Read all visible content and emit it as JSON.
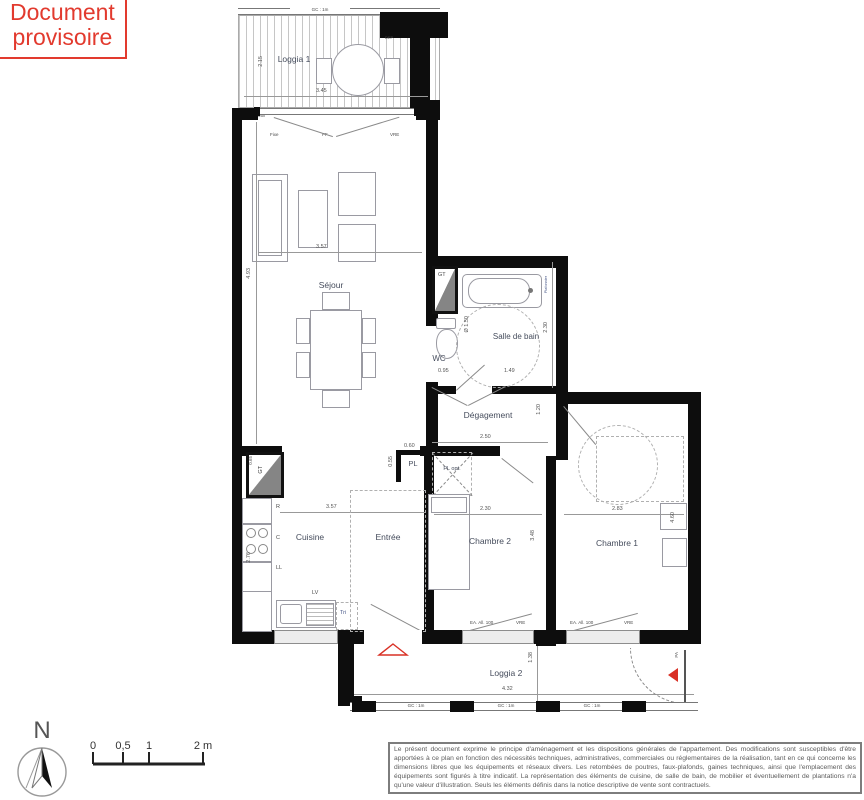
{
  "stamp": {
    "line1": "Document",
    "line2": "provisoire"
  },
  "colors": {
    "stamp_red": "#e23a2e",
    "plan_accent_red": "#d93025",
    "wall_black": "#0d0d0d"
  },
  "plan": {
    "rooms": {
      "loggia1": "Loggia 1",
      "sejour": "Séjour",
      "salle_de_bain": "Salle de bain",
      "wc": "WC",
      "degagement": "Dégagement",
      "pl": "PL",
      "pl_opt": "PL opt.",
      "cuisine": "Cuisine",
      "entree": "Entrée",
      "chambre2": "Chambre 2",
      "chambre1": "Chambre 1",
      "loggia2": "Loggia 2"
    },
    "annotations": {
      "gc": "GC : 1m",
      "fixe": "Fixe",
      "pf": "PF",
      "vre": "VRE",
      "ea": "EA. All. 100",
      "gt": "GT",
      "pa": "PA",
      "dep": "DEP",
      "seuil": "Seuil",
      "tri": "Tri",
      "lv": "LV",
      "ll": "LL",
      "c": "C",
      "r": "R",
      "plafonnier": "Plafonnier",
      "diametre": "Ø 1.50"
    },
    "dims": {
      "loggia1_h": "2.15",
      "loggia1_w": "3.45",
      "sejour_w": "3.57",
      "sejour_h": "4.93",
      "sdb_h": "2.30",
      "wc_w": "0.95",
      "sdb_w": "1.49",
      "deg_w": "2.50",
      "deg_h": "1.20",
      "pl_w": "0.60",
      "pl_h": "0.55",
      "gt_h": "0.65",
      "cuisine_w": "3.57",
      "cuisine_h": "2.76",
      "ch2_w": "2.30",
      "ch2_h": "3.48",
      "ch1_w": "2.83",
      "ch1_h": "4.60",
      "loggia2_w": "4.32",
      "loggia2_h": "1.38"
    }
  },
  "compass": {
    "label": "N"
  },
  "scale_bar": {
    "t0": "0",
    "t05": "0,5",
    "t1": "1",
    "t2": "2 m"
  },
  "disclaimer": {
    "text": "Le présent document exprime le principe d'aménagement et les dispositions générales de l'appartement. Des modifications sont susceptibles d'être apportées à ce plan en fonction des nécessités techniques, administratives, commerciales ou réglementaires de la réalisation, tant en ce qui concerne les dimensions libres que les équipements et réseaux divers. Les retombées de poutres, faux-plafonds, gaines techniques, ainsi que l'emplacement des équipements sont figurés à titre indicatif. La représentation des éléments de cuisine, de salle de bain, de mobilier et éventuellement de plantations n'a qu'une valeur d'illustration. Seuls les éléments définis dans la notice descriptive de vente sont contractuels."
  }
}
